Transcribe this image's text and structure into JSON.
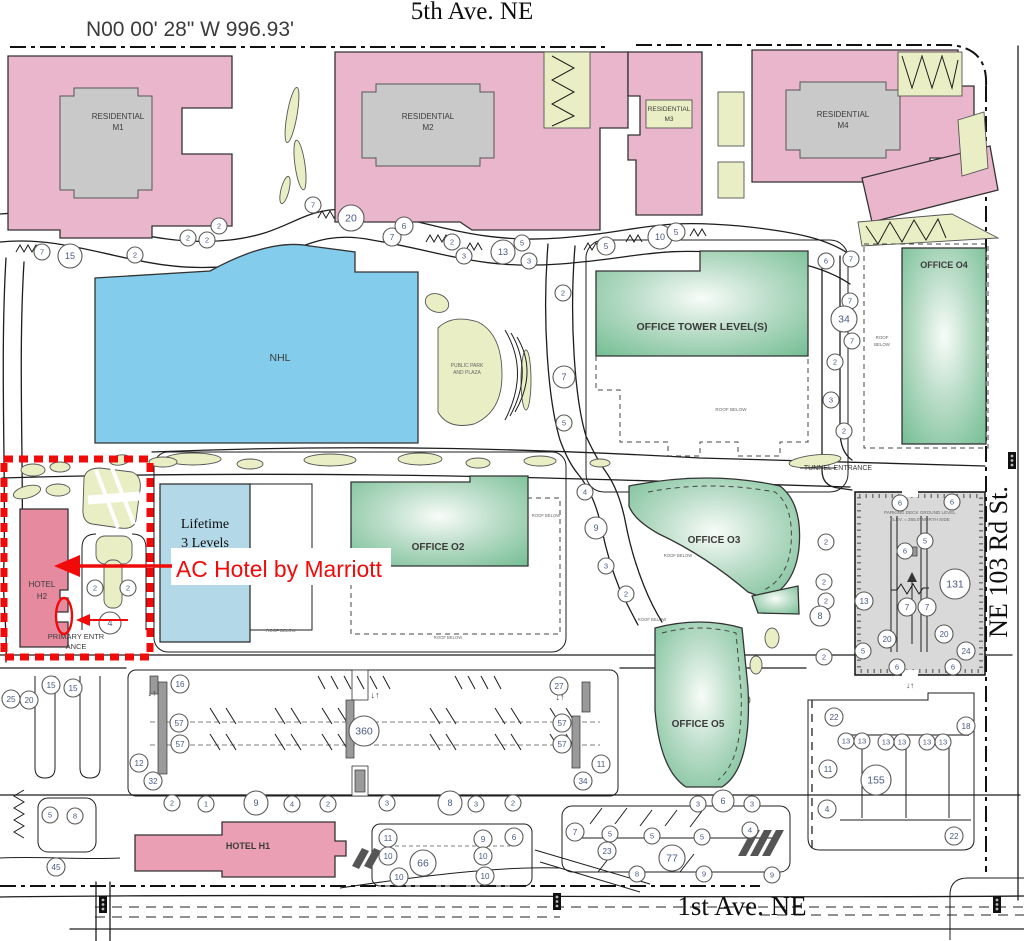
{
  "survey_bearing": "N00 00' 28\" W 996.93'",
  "streets": {
    "north": "5th Ave. NE",
    "south": "1st Ave. NE",
    "east": "NE 103 Rd St."
  },
  "callout": {
    "text": "AC Hotel by Marriott"
  },
  "buildings": {
    "residential_word": "RESIDENTIAL",
    "m1": "M1",
    "m2": "M2",
    "m3": "M3",
    "m4": "M4",
    "nhl": "NHL",
    "park_line1": "PUBLIC PARK",
    "park_line2": "AND PLAZA",
    "office_tower": "OFFICE TOWER LEVEL(S)",
    "office_o2": "OFFICE O2",
    "office_o3": "OFFICE O3",
    "office_o4": "OFFICE O4",
    "office_o5": "OFFICE O5",
    "lifetime_line1": "Lifetime",
    "lifetime_line2": "3 Levels",
    "hotel_h2_line1": "HOTEL",
    "hotel_h2_line2": "H2",
    "hotel_h1": "HOTEL H1"
  },
  "notes": {
    "roof_below": "ROOF BELOW",
    "roof_word": "ROOF",
    "below_word": "BELOW",
    "tunnel": "TUNNEL ENTRANCE",
    "primary_line1": "PRIMARY ENTR",
    "primary_line2": "ANCE",
    "deck_line1": "PARKING DECK GROUND LEVEL",
    "deck_line2": "ELEV. = 265.0' NORTH SIDE"
  },
  "colors": {
    "residential_pink": "#eab6cc",
    "hotel_h2_pink": "#e68aa0",
    "hotel_h1_pink": "#eb9fb4",
    "nhl_blue": "#84ccec",
    "lifetime_blue": "#b3d9e8",
    "office_green": "#72bd92",
    "landscape_olive": "#e9eec4",
    "parking_gray": "#d9d9d9",
    "highlight_red": "#f10a0a",
    "badge_number_blue": "#4a5a80"
  },
  "badges": [
    {
      "x": 42,
      "y": 252,
      "r": 8,
      "n": "7"
    },
    {
      "x": 70,
      "y": 256,
      "r": 12,
      "n": "15"
    },
    {
      "x": 135,
      "y": 255,
      "r": 8,
      "n": "2"
    },
    {
      "x": 188,
      "y": 238,
      "r": 8,
      "n": "2"
    },
    {
      "x": 207,
      "y": 240,
      "r": 8,
      "n": "2"
    },
    {
      "x": 219,
      "y": 226,
      "r": 8,
      "n": "2"
    },
    {
      "x": 313,
      "y": 205,
      "r": 8,
      "n": "7"
    },
    {
      "x": 351,
      "y": 218,
      "r": 13,
      "n": "20"
    },
    {
      "x": 392,
      "y": 237,
      "r": 9,
      "n": "7"
    },
    {
      "x": 404,
      "y": 226,
      "r": 9,
      "n": "6"
    },
    {
      "x": 452,
      "y": 242,
      "r": 8,
      "n": "2"
    },
    {
      "x": 464,
      "y": 256,
      "r": 8,
      "n": "3"
    },
    {
      "x": 503,
      "y": 252,
      "r": 12,
      "n": "13"
    },
    {
      "x": 522,
      "y": 243,
      "r": 8,
      "n": "5"
    },
    {
      "x": 529,
      "y": 261,
      "r": 8,
      "n": "3"
    },
    {
      "x": 606,
      "y": 246,
      "r": 9,
      "n": "5"
    },
    {
      "x": 660,
      "y": 237,
      "r": 12,
      "n": "10"
    },
    {
      "x": 676,
      "y": 232,
      "r": 9,
      "n": "5"
    },
    {
      "x": 826,
      "y": 261,
      "r": 8,
      "n": "6"
    },
    {
      "x": 851,
      "y": 259,
      "r": 8,
      "n": "7"
    },
    {
      "x": 563,
      "y": 293,
      "r": 8,
      "n": "2"
    },
    {
      "x": 564,
      "y": 377,
      "r": 11,
      "n": "7"
    },
    {
      "x": 564,
      "y": 423,
      "r": 8,
      "n": "5"
    },
    {
      "x": 850,
      "y": 301,
      "r": 8,
      "n": "7"
    },
    {
      "x": 844,
      "y": 319,
      "r": 13,
      "n": "34"
    },
    {
      "x": 852,
      "y": 341,
      "r": 8,
      "n": "7"
    },
    {
      "x": 835,
      "y": 362,
      "r": 8,
      "n": "2"
    },
    {
      "x": 831,
      "y": 400,
      "r": 8,
      "n": "3"
    },
    {
      "x": 844,
      "y": 431,
      "r": 8,
      "n": "2"
    },
    {
      "x": 95,
      "y": 588,
      "r": 8,
      "n": "2"
    },
    {
      "x": 128,
      "y": 588,
      "r": 8,
      "n": "2"
    },
    {
      "x": 110,
      "y": 623,
      "r": 11,
      "n": "4"
    },
    {
      "x": 585,
      "y": 492,
      "r": 8,
      "n": "4"
    },
    {
      "x": 596,
      "y": 528,
      "r": 11,
      "n": "9"
    },
    {
      "x": 606,
      "y": 566,
      "r": 8,
      "n": "3"
    },
    {
      "x": 626,
      "y": 594,
      "r": 8,
      "n": "2"
    },
    {
      "x": 826,
      "y": 542,
      "r": 8,
      "n": "2"
    },
    {
      "x": 824,
      "y": 582,
      "r": 8,
      "n": "2"
    },
    {
      "x": 826,
      "y": 601,
      "r": 8,
      "n": "2"
    },
    {
      "x": 820,
      "y": 616,
      "r": 10,
      "n": "8"
    },
    {
      "x": 824,
      "y": 657,
      "r": 8,
      "n": "2"
    },
    {
      "x": 900,
      "y": 503,
      "r": 8,
      "n": "6"
    },
    {
      "x": 952,
      "y": 502,
      "r": 8,
      "n": "6"
    },
    {
      "x": 925,
      "y": 541,
      "r": 8,
      "n": "5"
    },
    {
      "x": 905,
      "y": 551,
      "r": 8,
      "n": "6"
    },
    {
      "x": 955,
      "y": 584,
      "r": 15,
      "n": "131"
    },
    {
      "x": 864,
      "y": 601,
      "r": 9,
      "n": "13"
    },
    {
      "x": 907,
      "y": 607,
      "r": 9,
      "n": "7"
    },
    {
      "x": 927,
      "y": 607,
      "r": 9,
      "n": "7"
    },
    {
      "x": 887,
      "y": 639,
      "r": 9,
      "n": "20"
    },
    {
      "x": 944,
      "y": 634,
      "r": 9,
      "n": "20"
    },
    {
      "x": 966,
      "y": 651,
      "r": 9,
      "n": "24"
    },
    {
      "x": 863,
      "y": 651,
      "r": 8,
      "n": "5"
    },
    {
      "x": 897,
      "y": 667,
      "r": 8,
      "n": "6"
    },
    {
      "x": 953,
      "y": 667,
      "r": 8,
      "n": "6"
    },
    {
      "x": 180,
      "y": 684,
      "r": 9,
      "n": "16"
    },
    {
      "x": 179,
      "y": 723,
      "r": 9,
      "n": "57"
    },
    {
      "x": 180,
      "y": 744,
      "r": 9,
      "n": "57"
    },
    {
      "x": 139,
      "y": 763,
      "r": 9,
      "n": "12"
    },
    {
      "x": 153,
      "y": 781,
      "r": 9,
      "n": "32"
    },
    {
      "x": 364,
      "y": 731,
      "r": 15,
      "n": "360"
    },
    {
      "x": 559,
      "y": 686,
      "r": 9,
      "n": "27"
    },
    {
      "x": 562,
      "y": 723,
      "r": 9,
      "n": "57"
    },
    {
      "x": 562,
      "y": 744,
      "r": 9,
      "n": "57"
    },
    {
      "x": 601,
      "y": 764,
      "r": 9,
      "n": "11"
    },
    {
      "x": 583,
      "y": 781,
      "r": 9,
      "n": "34"
    },
    {
      "x": 11,
      "y": 699,
      "r": 9,
      "n": "25"
    },
    {
      "x": 29,
      "y": 700,
      "r": 9,
      "n": "20"
    },
    {
      "x": 51,
      "y": 685,
      "r": 9,
      "n": "15"
    },
    {
      "x": 73,
      "y": 688,
      "r": 9,
      "n": "15"
    },
    {
      "x": 50,
      "y": 815,
      "r": 8,
      "n": "5"
    },
    {
      "x": 75,
      "y": 816,
      "r": 8,
      "n": "8"
    },
    {
      "x": 56,
      "y": 867,
      "r": 9,
      "n": "45"
    },
    {
      "x": 172,
      "y": 803,
      "r": 8,
      "n": "2"
    },
    {
      "x": 206,
      "y": 804,
      "r": 8,
      "n": "1"
    },
    {
      "x": 256,
      "y": 803,
      "r": 12,
      "n": "9"
    },
    {
      "x": 292,
      "y": 804,
      "r": 8,
      "n": "4"
    },
    {
      "x": 328,
      "y": 804,
      "r": 8,
      "n": "2"
    },
    {
      "x": 387,
      "y": 803,
      "r": 8,
      "n": "3"
    },
    {
      "x": 450,
      "y": 803,
      "r": 12,
      "n": "8"
    },
    {
      "x": 476,
      "y": 804,
      "r": 8,
      "n": "3"
    },
    {
      "x": 513,
      "y": 803,
      "r": 8,
      "n": "2"
    },
    {
      "x": 388,
      "y": 838,
      "r": 9,
      "n": "11"
    },
    {
      "x": 388,
      "y": 856,
      "r": 9,
      "n": "10"
    },
    {
      "x": 423,
      "y": 863,
      "r": 13,
      "n": "66"
    },
    {
      "x": 483,
      "y": 839,
      "r": 9,
      "n": "9"
    },
    {
      "x": 483,
      "y": 856,
      "r": 9,
      "n": "10"
    },
    {
      "x": 514,
      "y": 837,
      "r": 9,
      "n": "6"
    },
    {
      "x": 399,
      "y": 877,
      "r": 9,
      "n": "10"
    },
    {
      "x": 485,
      "y": 876,
      "r": 9,
      "n": "10"
    },
    {
      "x": 698,
      "y": 804,
      "r": 8,
      "n": "3"
    },
    {
      "x": 723,
      "y": 801,
      "r": 11,
      "n": "6"
    },
    {
      "x": 752,
      "y": 804,
      "r": 8,
      "n": "3"
    },
    {
      "x": 575,
      "y": 832,
      "r": 9,
      "n": "7"
    },
    {
      "x": 610,
      "y": 834,
      "r": 8,
      "n": "5"
    },
    {
      "x": 607,
      "y": 851,
      "r": 9,
      "n": "23"
    },
    {
      "x": 652,
      "y": 836,
      "r": 8,
      "n": "5"
    },
    {
      "x": 702,
      "y": 837,
      "r": 8,
      "n": "5"
    },
    {
      "x": 750,
      "y": 830,
      "r": 8,
      "n": "4"
    },
    {
      "x": 672,
      "y": 858,
      "r": 13,
      "n": "77"
    },
    {
      "x": 637,
      "y": 874,
      "r": 8,
      "n": "8"
    },
    {
      "x": 704,
      "y": 874,
      "r": 8,
      "n": "9"
    },
    {
      "x": 772,
      "y": 875,
      "r": 8,
      "n": "9"
    },
    {
      "x": 834,
      "y": 717,
      "r": 9,
      "n": "22"
    },
    {
      "x": 966,
      "y": 726,
      "r": 9,
      "n": "18"
    },
    {
      "x": 846,
      "y": 741,
      "r": 8,
      "n": "13"
    },
    {
      "x": 862,
      "y": 741,
      "r": 8,
      "n": "13"
    },
    {
      "x": 886,
      "y": 742,
      "r": 8,
      "n": "13"
    },
    {
      "x": 902,
      "y": 742,
      "r": 8,
      "n": "13"
    },
    {
      "x": 927,
      "y": 742,
      "r": 8,
      "n": "13"
    },
    {
      "x": 943,
      "y": 742,
      "r": 8,
      "n": "13"
    },
    {
      "x": 828,
      "y": 769,
      "r": 9,
      "n": "11"
    },
    {
      "x": 876,
      "y": 780,
      "r": 15,
      "n": "155"
    },
    {
      "x": 827,
      "y": 809,
      "r": 9,
      "n": "4"
    },
    {
      "x": 954,
      "y": 836,
      "r": 9,
      "n": "22"
    }
  ]
}
